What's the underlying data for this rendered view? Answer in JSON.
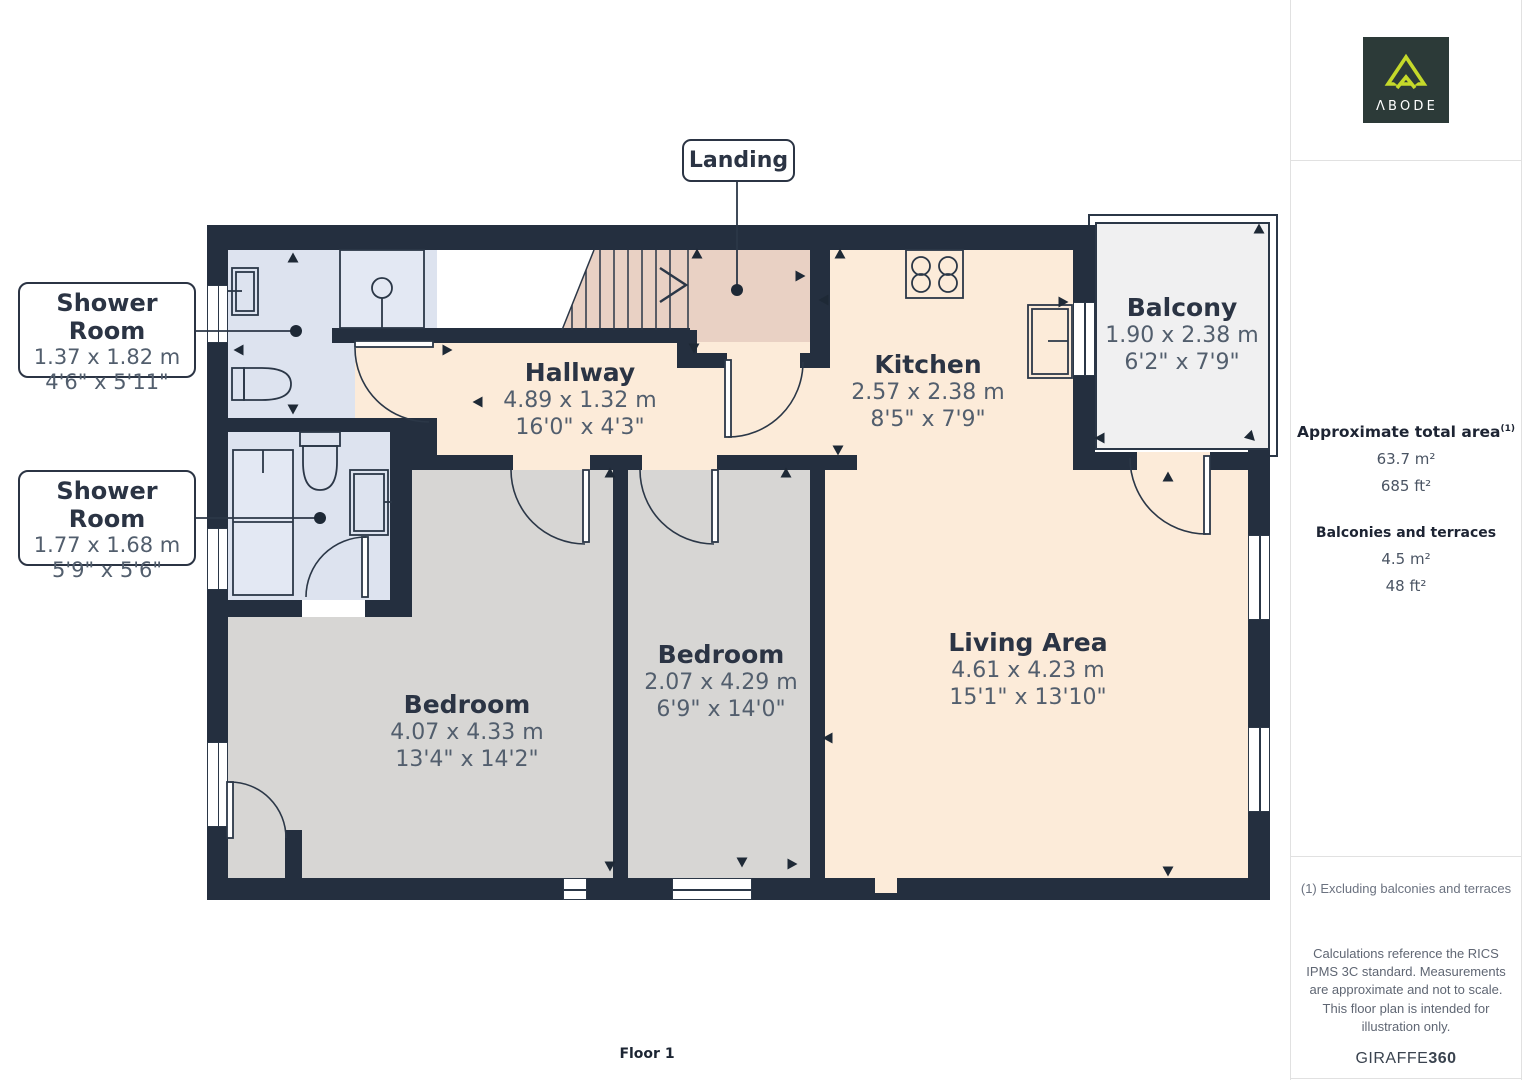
{
  "palette": {
    "wall": "#242f3f",
    "cream": "#fcebd9",
    "landing_pink": "#e9d1c4",
    "bath_blue": "#dde3ef",
    "bedroom_gray": "#d7d6d4",
    "balcony_gray": "#f0f0f1",
    "ink": "#2b3444",
    "dim_text": "#525e6d",
    "logo_bg": "#2c3a38",
    "logo_accent": "#c5d92a"
  },
  "branding": {
    "logo_wordmark": "ΛBODE"
  },
  "floorplan": {
    "floor_label": "Floor 1",
    "landing_label": "Landing",
    "rooms": [
      {
        "name": "Hallway",
        "metric": "4.89 x 1.32 m",
        "imperial": "16'0\" x 4'3\""
      },
      {
        "name": "Kitchen",
        "metric": "2.57 x 2.38 m",
        "imperial": "8'5\" x 7'9\""
      },
      {
        "name": "Balcony",
        "metric": "1.90 x 2.38 m",
        "imperial": "6'2\" x 7'9\""
      },
      {
        "name": "Bedroom",
        "metric": "4.07 x 4.33 m",
        "imperial": "13'4\" x 14'2\""
      },
      {
        "name": "Bedroom",
        "metric": "2.07 x 4.29 m",
        "imperial": "6'9\" x 14'0\""
      },
      {
        "name": "Living Area",
        "metric": "4.61 x 4.23 m",
        "imperial": "15'1\" x 13'10\""
      }
    ],
    "callouts": [
      {
        "name": "Shower Room",
        "metric": "1.37 x 1.82 m",
        "imperial": "4'6\" x 5'11\""
      },
      {
        "name": "Shower Room",
        "metric": "1.77 x 1.68 m",
        "imperial": "5'9\" x 5'6\""
      }
    ]
  },
  "sidebar": {
    "total_area": {
      "heading": "Approximate total area",
      "sup": "(1)",
      "metric": "63.7 m²",
      "imperial": "685 ft²"
    },
    "balconies": {
      "heading": "Balconies and terraces",
      "metric": "4.5 m²",
      "imperial": "48 ft²"
    },
    "footnote": "(1) Excluding balconies and terraces",
    "disclaimer": "Calculations reference the RICS IPMS 3C standard. Measurements are approximate and not to scale. This floor plan is intended for illustration only.",
    "brand_footer_name": "GIRAFFE",
    "brand_footer_suffix": "360"
  }
}
